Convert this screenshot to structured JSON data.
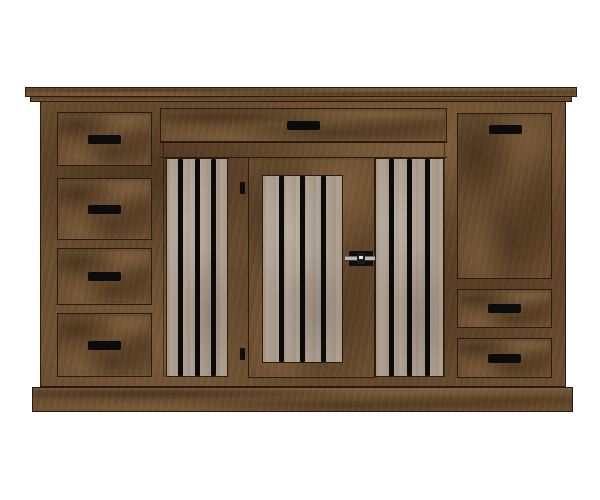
{
  "scene": {
    "background": "#ffffff",
    "subject": "wooden-dog-crate-credenza"
  },
  "colors": {
    "wood_base": "#6b4e30",
    "wood_dark": "#4a3017",
    "wood_light": "#8a6a45",
    "outline": "#2a1b0c",
    "slat_panel": "#ab9d8e",
    "bar_black": "#0b0b0b",
    "handle_black": "#0b0b0b",
    "latch_plate": "#0e0e0e",
    "latch_bar": "#b9b9b9",
    "latch_glint": "#e8e8e8"
  },
  "structure": {
    "left_drawer_count": 4,
    "top_center_drawer_count": 1,
    "right_drawer_count": 2,
    "right_door_count": 1,
    "center_kennel_door_count": 1,
    "slat_panel_count": 2,
    "bars_per_slat_panel": 3,
    "bars_on_center_door": 3,
    "hinge_count": 2,
    "latch_count": 1,
    "handle_count": 8
  }
}
